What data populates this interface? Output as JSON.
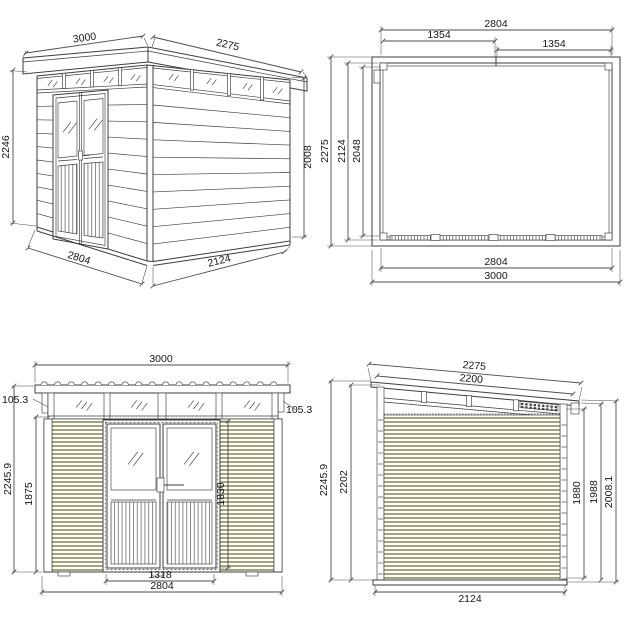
{
  "colors": {
    "background": "#ffffff",
    "line": "#3d3d3d",
    "dim_line": "#4c4c4c",
    "text": "#161616",
    "siding": "#a4a478"
  },
  "views": {
    "perspective": {
      "dims": {
        "roof_front_width": "3000",
        "roof_side_depth": "2275",
        "front_height": "2246",
        "rear_height": "2008",
        "base_front_width": "2804",
        "base_side_depth": "2124"
      }
    },
    "plan": {
      "dims": {
        "wall_width_top": "2804",
        "door_half_left": "1354",
        "door_half_right": "1354",
        "depth_outer": "2275",
        "depth_wall": "2124",
        "depth_inner": "2048",
        "wall_width_bottom": "2804",
        "roof_width": "3000"
      }
    },
    "front_elevation": {
      "dims": {
        "roof_width": "3000",
        "fascia_left": "105.3",
        "fascia_right": "105.3",
        "total_height": "2245.9",
        "wall_height": "1875",
        "door_height": "1830",
        "door_width": "1318",
        "wall_width": "2804"
      }
    },
    "side_elevation": {
      "dims": {
        "roof_length_outer": "2275",
        "roof_length_inner": "2200",
        "front_height_outer": "2245.9",
        "front_height_inner": "2202",
        "rear_wall_height": "1880",
        "rear_height_mid": "1988",
        "rear_height_outer": "2008.1",
        "base_depth": "2124"
      }
    }
  }
}
